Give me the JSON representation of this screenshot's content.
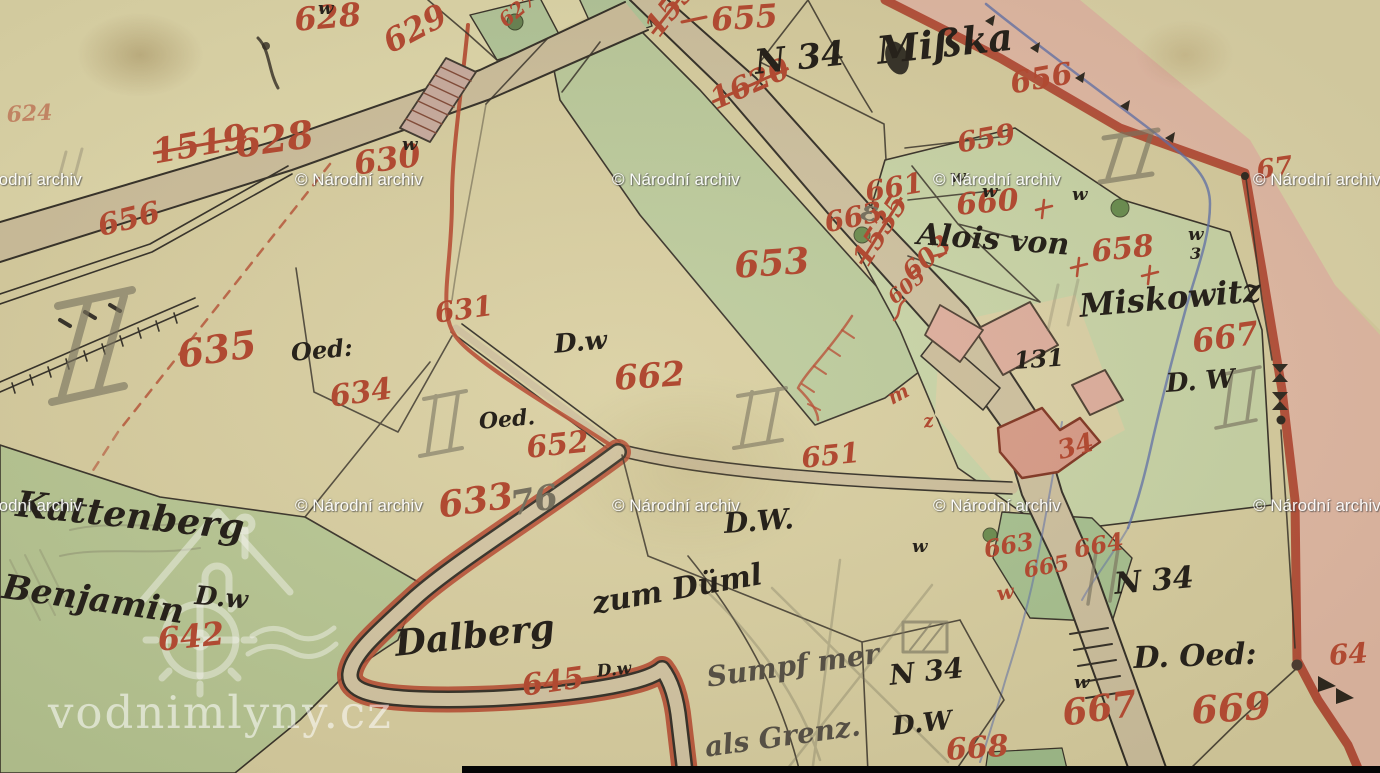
{
  "map": {
    "type": "historical-cadastral-map",
    "archive_watermark": "© Národní archiv",
    "site_watermark": "vodnimlyny.cz",
    "place_names": [
      "Mißka",
      "Miskowitz",
      "Kattenberg",
      "Dalberg zum Düml",
      "Alois von",
      "Benjamin"
    ],
    "district_marks": [
      "N 34",
      "N 34",
      "N 34"
    ],
    "land_use_marks": [
      "D.w",
      "Oed:",
      "Oed.",
      "D.W.",
      "D. W",
      "D.w",
      "D.W",
      "D. Oed:"
    ],
    "house_number": "131"
  },
  "palette": {
    "paper": "#d8cfa2",
    "paper_light": "#e0d8ac",
    "road_tan": "#cdbf9e",
    "green_field": "#b7c795",
    "green_strip": "#bccb9e",
    "green_right": "#c9d5a9",
    "pond_green": "#a6c191",
    "pink_band": "#e6b6a9",
    "border_red": "#b0402c",
    "red_ink": "#b04a32",
    "black_ink": "#2e2a24",
    "pencil": "#77715f",
    "stream_blue": "#5a6cae",
    "building_pink": "#dfae9f"
  },
  "labels": {
    "red_numbers": [
      {
        "t": "624",
        "x": 6,
        "y": 104,
        "s": 22,
        "r": -3,
        "o": 0.55
      },
      {
        "t": "628",
        "x": 293,
        "y": 4,
        "s": 32,
        "r": -5
      },
      {
        "t": "629",
        "x": 378,
        "y": 30,
        "s": 32,
        "r": -28
      },
      {
        "t": "1519",
        "x": 150,
        "y": 136,
        "s": 34,
        "r": -10,
        "k": true
      },
      {
        "t": "628",
        "x": 232,
        "y": 126,
        "s": 38,
        "r": -8
      },
      {
        "t": "656",
        "x": 95,
        "y": 213,
        "s": 30,
        "r": -14
      },
      {
        "t": "630",
        "x": 352,
        "y": 148,
        "s": 32,
        "r": -8
      },
      {
        "t": "627",
        "x": 495,
        "y": 15,
        "s": 20,
        "r": -40
      },
      {
        "t": "1535",
        "x": 640,
        "y": 24,
        "s": 30,
        "r": -52,
        "k": true
      },
      {
        "t": "1620",
        "x": 706,
        "y": 88,
        "s": 30,
        "r": -24,
        "k": true
      },
      {
        "t": "655",
        "x": 710,
        "y": 4,
        "s": 32,
        "r": -4
      },
      {
        "t": "656",
        "x": 1008,
        "y": 70,
        "s": 30,
        "r": -10
      },
      {
        "t": "653",
        "x": 733,
        "y": 248,
        "s": 36,
        "r": -4
      },
      {
        "t": "659",
        "x": 955,
        "y": 130,
        "s": 28,
        "r": -10
      },
      {
        "t": "660",
        "x": 955,
        "y": 191,
        "s": 30,
        "r": -5
      },
      {
        "t": "661",
        "x": 863,
        "y": 179,
        "s": 28,
        "r": -10
      },
      {
        "t": "663",
        "x": 822,
        "y": 210,
        "s": 28,
        "r": -12
      },
      {
        "t": "603",
        "x": 898,
        "y": 266,
        "s": 26,
        "r": -40
      },
      {
        "t": "605",
        "x": 884,
        "y": 292,
        "s": 20,
        "r": -40
      },
      {
        "t": "1535",
        "x": 848,
        "y": 256,
        "s": 28,
        "r": -58,
        "k": true
      },
      {
        "t": "658",
        "x": 1090,
        "y": 238,
        "s": 30,
        "r": -6
      },
      {
        "t": "667",
        "x": 1190,
        "y": 326,
        "s": 32,
        "r": -8
      },
      {
        "t": "34",
        "x": 1055,
        "y": 439,
        "s": 26,
        "r": -15
      },
      {
        "t": "651",
        "x": 800,
        "y": 445,
        "s": 28,
        "r": -6
      },
      {
        "t": "631",
        "x": 433,
        "y": 300,
        "s": 28,
        "r": -8
      },
      {
        "t": "635",
        "x": 175,
        "y": 336,
        "s": 38,
        "r": -8
      },
      {
        "t": "634",
        "x": 328,
        "y": 383,
        "s": 30,
        "r": -8
      },
      {
        "t": "662",
        "x": 613,
        "y": 362,
        "s": 34,
        "r": -4
      },
      {
        "t": "652",
        "x": 525,
        "y": 434,
        "s": 30,
        "r": -6
      },
      {
        "t": "633",
        "x": 436,
        "y": 488,
        "s": 36,
        "r": -8
      },
      {
        "t": "642",
        "x": 156,
        "y": 624,
        "s": 32,
        "r": -6
      },
      {
        "t": "645",
        "x": 520,
        "y": 672,
        "s": 30,
        "r": -8
      },
      {
        "t": "663",
        "x": 982,
        "y": 538,
        "s": 24,
        "r": -10
      },
      {
        "t": "664",
        "x": 1072,
        "y": 538,
        "s": 24,
        "r": -10
      },
      {
        "t": "665",
        "x": 1022,
        "y": 560,
        "s": 22,
        "r": -10
      },
      {
        "t": "w",
        "x": 995,
        "y": 584,
        "s": 20,
        "r": -10
      },
      {
        "t": "667",
        "x": 1060,
        "y": 696,
        "s": 36,
        "r": -8
      },
      {
        "t": "668",
        "x": 945,
        "y": 736,
        "s": 30,
        "r": -4
      },
      {
        "t": "669",
        "x": 1190,
        "y": 692,
        "s": 38,
        "r": -4
      },
      {
        "t": "64",
        "x": 1328,
        "y": 642,
        "s": 28,
        "r": -4
      },
      {
        "t": "67",
        "x": 1255,
        "y": 158,
        "s": 26,
        "r": -8
      },
      {
        "t": "m",
        "x": 884,
        "y": 390,
        "s": 20,
        "r": -28
      },
      {
        "t": "z",
        "x": 922,
        "y": 414,
        "s": 18,
        "r": -10
      }
    ],
    "black_texts": [
      {
        "t": "N 34",
        "x": 753,
        "y": 46,
        "s": 34,
        "r": -6
      },
      {
        "t": "Mißka",
        "x": 875,
        "y": 32,
        "s": 38,
        "r": -6
      },
      {
        "t": "Alois von",
        "x": 918,
        "y": 220,
        "s": 30,
        "r": 4
      },
      {
        "t": "Miskowitz",
        "x": 1078,
        "y": 290,
        "s": 32,
        "r": -5
      },
      {
        "t": "131",
        "x": 1013,
        "y": 349,
        "s": 24,
        "r": -4
      },
      {
        "t": "D.w",
        "x": 553,
        "y": 332,
        "s": 26,
        "r": -5
      },
      {
        "t": "Oed:",
        "x": 290,
        "y": 341,
        "s": 24,
        "r": -5
      },
      {
        "t": "Oed.",
        "x": 478,
        "y": 411,
        "s": 22,
        "r": -5
      },
      {
        "t": "D.W.",
        "x": 723,
        "y": 510,
        "s": 28,
        "r": -4
      },
      {
        "t": "D. W",
        "x": 1165,
        "y": 371,
        "s": 26,
        "r": -4
      },
      {
        "t": "D.w",
        "x": 596,
        "y": 664,
        "s": 17,
        "r": -6
      },
      {
        "t": "N 34",
        "x": 888,
        "y": 662,
        "s": 28,
        "r": -6
      },
      {
        "t": "D.W",
        "x": 891,
        "y": 714,
        "s": 26,
        "r": -6
      },
      {
        "t": "N 34",
        "x": 1113,
        "y": 570,
        "s": 30,
        "r": -5
      },
      {
        "t": "D. Oed:",
        "x": 1133,
        "y": 644,
        "s": 30,
        "r": -2
      },
      {
        "t": "Kattenberg",
        "x": 18,
        "y": 486,
        "s": 36,
        "r": 6
      },
      {
        "t": "Benjamin",
        "x": 5,
        "y": 570,
        "s": 34,
        "r": 8
      },
      {
        "t": "D.w",
        "x": 196,
        "y": 583,
        "s": 26,
        "r": 5
      },
      {
        "t": "Dalberg",
        "x": 393,
        "y": 626,
        "s": 36,
        "r": -6
      },
      {
        "t": "zum Düml",
        "x": 590,
        "y": 590,
        "s": 30,
        "r": -10
      },
      {
        "t": "w",
        "x": 318,
        "y": 0,
        "s": 18,
        "r": 0
      },
      {
        "t": "w",
        "x": 402,
        "y": 136,
        "s": 18,
        "r": 0
      },
      {
        "t": "w",
        "x": 950,
        "y": 168,
        "s": 18,
        "r": 0
      },
      {
        "t": "w",
        "x": 982,
        "y": 183,
        "s": 18,
        "r": 0
      },
      {
        "t": "w",
        "x": 1072,
        "y": 186,
        "s": 18,
        "r": 0
      },
      {
        "t": "w",
        "x": 1188,
        "y": 226,
        "s": 18,
        "r": 0
      },
      {
        "t": "3",
        "x": 1190,
        "y": 246,
        "s": 16,
        "r": 0
      },
      {
        "t": "w",
        "x": 912,
        "y": 538,
        "s": 18,
        "r": 0
      },
      {
        "t": "w",
        "x": 1074,
        "y": 674,
        "s": 18,
        "r": 0
      }
    ],
    "pencil_texts": [
      {
        "t": "76",
        "x": 508,
        "y": 488,
        "s": 34,
        "r": -10
      },
      {
        "t": "ε",
        "x": 864,
        "y": 196,
        "s": 28,
        "r": 12
      }
    ],
    "pencil_notes": [
      {
        "t": "Sumpf mer",
        "x": 705,
        "y": 664,
        "s": 28,
        "r": -8
      },
      {
        "t": "als Grenz.",
        "x": 703,
        "y": 734,
        "s": 28,
        "r": -8
      }
    ],
    "watermarks": [
      {
        "x": -46,
        "y": 170
      },
      {
        "x": 295,
        "y": 170
      },
      {
        "x": 612,
        "y": 170
      },
      {
        "x": 933,
        "y": 170
      },
      {
        "x": 1253,
        "y": 170
      },
      {
        "x": -46,
        "y": 496
      },
      {
        "x": 295,
        "y": 496
      },
      {
        "x": 612,
        "y": 496
      },
      {
        "x": 933,
        "y": 496
      },
      {
        "x": 1253,
        "y": 496
      }
    ],
    "site_watermark_pos": {
      "x": 48,
      "y": 686
    }
  }
}
